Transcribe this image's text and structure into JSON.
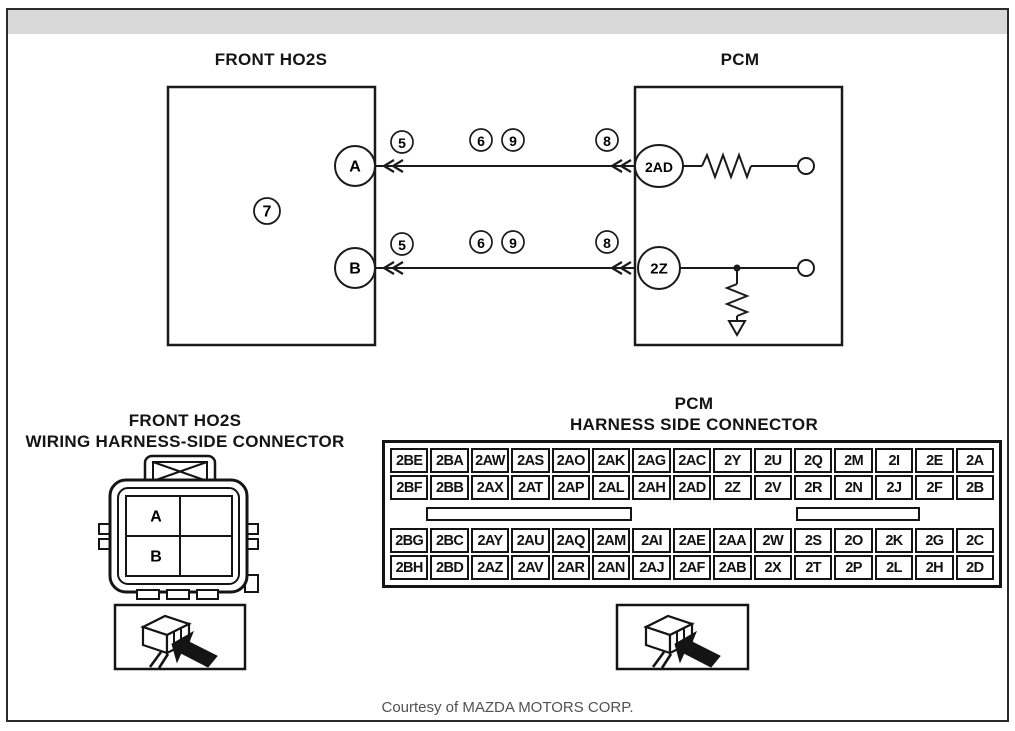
{
  "page": {
    "courtesy": "Courtesy of MAZDA MOTORS CORP."
  },
  "colors": {
    "line": "#1a1a1a",
    "topbar": "#d8d8d8",
    "frame_border": "#2b2b2b",
    "courtesy_text": "#515154"
  },
  "schematic": {
    "left_box_title": "FRONT HO2S",
    "right_box_title": "PCM",
    "component_ref": "7",
    "terminals": {
      "sensor_a": "A",
      "sensor_b": "B",
      "pcm_a": "2AD",
      "pcm_b": "2Z"
    },
    "wire_a_markers": [
      "5",
      "6",
      "9",
      "8"
    ],
    "wire_b_markers": [
      "5",
      "6",
      "9",
      "8"
    ]
  },
  "ho2s_connector": {
    "title_line1": "FRONT HO2S",
    "title_line2": "WIRING HARNESS-SIDE CONNECTOR",
    "pin_a": "A",
    "pin_b": "B"
  },
  "pcm_connector": {
    "title_line1": "PCM",
    "title_line2": "HARNESS SIDE CONNECTOR",
    "rows": [
      [
        "2BE",
        "2BA",
        "2AW",
        "2AS",
        "2AO",
        "2AK",
        "2AG",
        "2AC",
        "2Y",
        "2U",
        "2Q",
        "2M",
        "2I",
        "2E",
        "2A"
      ],
      [
        "2BF",
        "2BB",
        "2AX",
        "2AT",
        "2AP",
        "2AL",
        "2AH",
        "2AD",
        "2Z",
        "2V",
        "2R",
        "2N",
        "2J",
        "2F",
        "2B"
      ],
      [
        "2BG",
        "2BC",
        "2AY",
        "2AU",
        "2AQ",
        "2AM",
        "2AI",
        "2AE",
        "2AA",
        "2W",
        "2S",
        "2O",
        "2K",
        "2G",
        "2C"
      ],
      [
        "2BH",
        "2BD",
        "2AZ",
        "2AV",
        "2AR",
        "2AN",
        "2AJ",
        "2AF",
        "2AB",
        "2X",
        "2T",
        "2P",
        "2L",
        "2H",
        "2D"
      ]
    ]
  }
}
